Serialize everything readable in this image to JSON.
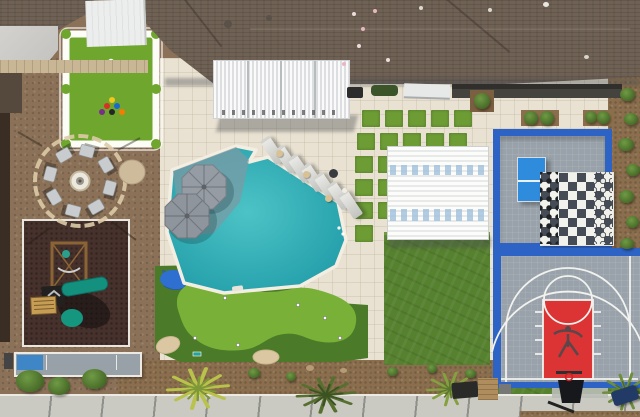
{
  "scene": {
    "type": "aerial-drone-photo",
    "description": "Top-down aerial view of a landscaped backyard entertainment space: freeform pool with baja shelf and umbrellas, lounge chairs, putting green with bunkers and pond, artificial lawn, giant lawn billiards table, fire pit circle, playground, shuffleboard court, game court with ping pong and giant chess, and a basketball half court"
  },
  "colors": {
    "pool_water": "#2fa9b0",
    "pool_shelf": "#7d9aa3",
    "roof_shingles": "#6f6154",
    "patio_pavers": "#e9e2d2",
    "gravel_yard": "#8b7157",
    "putting_green_bright": "#79b138",
    "turf_fringe": "#4b7a28",
    "lawn_turf": "#56812f",
    "court_border_blue": "#2d63c4",
    "court_tile_gray": "#99a2aa",
    "basketball_key_red": "#dc3434",
    "ping_pong_blue": "#2f8bdb",
    "playground_rubber": "#46312c",
    "slide_teal": "#15967f",
    "umbrella_gray": "#969ca4",
    "bunker_sand": "#dbc8a2",
    "walkway_concrete": "#cac9c2"
  },
  "features": {
    "billiards_lawn": {
      "rails": "white",
      "felt": "green-turf",
      "cue_ball": "white",
      "racked_balls": 6,
      "ball_colors": [
        "#f2c61d",
        "#d93025",
        "#1a67d2",
        "#7b2d8b",
        "#262626",
        "#f57c00"
      ]
    },
    "fire_pit_circle": {
      "chairs": 8,
      "center_fire_pit": 1,
      "boulder": 1,
      "border": "stone-ring"
    },
    "playground": {
      "surface": "dark-rubber",
      "border": "white",
      "slides": 2,
      "wood_structure": 1
    },
    "shuffleboard_court": {
      "end_zone_color": "blue",
      "surface": "gray",
      "border": "white"
    },
    "pool": {
      "umbrellas": 2,
      "loungers": 7,
      "side_tables": 3,
      "fire_bowl": 1,
      "baja_shelf": true
    },
    "putting_green": {
      "holes": 6,
      "bunkers": 2,
      "pond": 1
    },
    "turf_paver_squares": {
      "count": 17
    },
    "game_court": {
      "ping_pong_table": 1,
      "chess_board": {
        "rows": 8,
        "cols": 8,
        "dark_piece_columns": 2,
        "light_piece_columns": 2
      }
    },
    "basketball_half_court": {
      "key_color": "red",
      "logo": "jumpman-silhouette",
      "hoops": 1,
      "three_point_line": true,
      "free_throw_circle": true
    },
    "pergolas": {
      "attached_louvered": 1,
      "freestanding_louvered": 1
    },
    "planters": 3,
    "palm_trees": 4,
    "perimeter_bushes": 8,
    "walkway": {
      "material": "concrete-slabs"
    }
  }
}
